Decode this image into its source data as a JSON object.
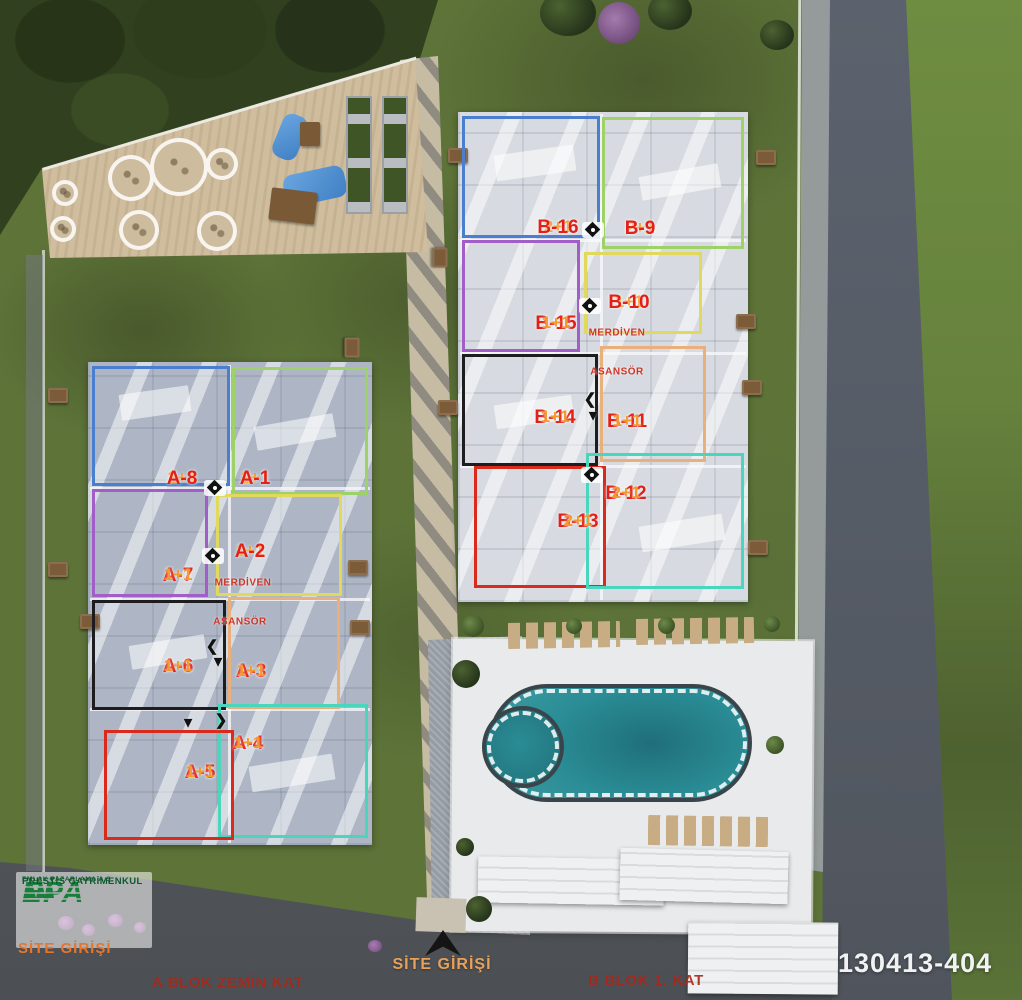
{
  "meta": {
    "reference_number": "130413-404"
  },
  "icons": {
    "chevron_left": "❮",
    "chevron_right": "❯",
    "chevron_down": "▼"
  },
  "logo": {
    "brand": "EPA",
    "line1": "EMLAK PAZARLAMA A.Ş.",
    "line2": "PRESTİS GAYRİMENKUL",
    "entrance_label": "SİTE GİRİŞİ"
  },
  "captions": {
    "site_entrance": "SİTE GİRİŞİ",
    "a_block_floor": "A BLOK ZEMİN  KAT",
    "b_block_floor": "B BLOK 1. KAT"
  },
  "core": {
    "stairs": "MERDİVEN",
    "elevator": "ASANSÖR"
  },
  "colors": {
    "unit_id_text": "#e31f17",
    "unit_type_text": "#f29a2c",
    "core_text": "#cf3426",
    "floor_caption_text": "#a8271b",
    "entrance_text": "#e8a159",
    "logo_entrance_text": "#e5762e",
    "reference_text": "#f0f2f3",
    "logo_green": "#177f3a",
    "pool_water": "#2a8c95",
    "grass": "#5d7338",
    "road": "#5a6066",
    "terrace": "#cfbd9d",
    "outlines": {
      "blue": "#4a7fd0",
      "green": "#9ed268",
      "purple": "#a05ec6",
      "yellow": "#e0d95c",
      "black": "#1d1d1f",
      "orange": "#eab07b",
      "teal": "#49d6bc",
      "red": "#da2a1c"
    }
  },
  "blocks": {
    "a": {
      "units": [
        {
          "id": "A-1",
          "type": "2+1",
          "outline": "green"
        },
        {
          "id": "A-2",
          "type": "1+1",
          "outline": "yellow"
        },
        {
          "id": "A-3",
          "type": "1+1",
          "outline": "orange"
        },
        {
          "id": "A-4",
          "type": "1+1",
          "outline": "teal"
        },
        {
          "id": "A-5",
          "type": "1+1",
          "outline": "red"
        },
        {
          "id": "A-6",
          "type": "1+1",
          "outline": "black"
        },
        {
          "id": "A-7",
          "type": "1+1",
          "outline": "purple"
        },
        {
          "id": "A-8",
          "type": "2+1",
          "outline": "blue"
        }
      ]
    },
    "b": {
      "units": [
        {
          "id": "B-9",
          "type": "2+1",
          "outline": "green"
        },
        {
          "id": "B-10",
          "type": "1+1",
          "outline": "yellow"
        },
        {
          "id": "B-11",
          "type": "1+1",
          "outline": "orange"
        },
        {
          "id": "B-12",
          "type": "2+1",
          "outline": "teal"
        },
        {
          "id": "B-13",
          "type": "2+1",
          "outline": "red"
        },
        {
          "id": "B-14",
          "type": "1+1",
          "outline": "black"
        },
        {
          "id": "B-15",
          "type": "1+1",
          "outline": "purple"
        },
        {
          "id": "B-16",
          "type": "2+1",
          "outline": "blue"
        }
      ]
    }
  }
}
